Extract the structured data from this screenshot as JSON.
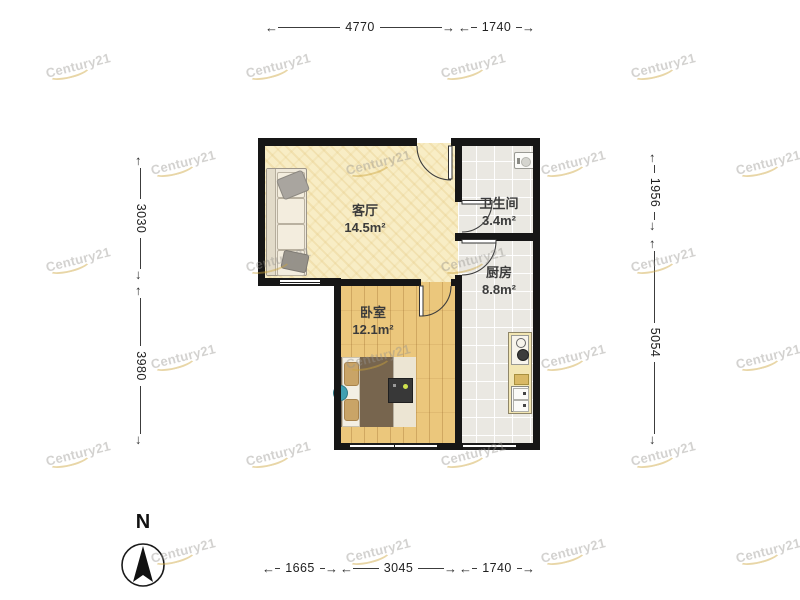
{
  "floorplan": {
    "rooms": [
      {
        "name": "living-room",
        "label": "客厅",
        "area": "14.5m²"
      },
      {
        "name": "bathroom",
        "label": "卫生间",
        "area": "3.4m²"
      },
      {
        "name": "kitchen",
        "label": "厨房",
        "area": "8.8m²"
      },
      {
        "name": "bedroom",
        "label": "卧室",
        "area": "12.1m²"
      }
    ],
    "dimensions_mm": {
      "top": [
        "4770",
        "1740"
      ],
      "bottom": [
        "1665",
        "3045",
        "1740"
      ],
      "left": [
        "3030",
        "3980"
      ],
      "right": [
        "1956",
        "5054"
      ]
    },
    "compass_label": "N",
    "watermark_text": "Century21",
    "colors": {
      "wall": "#161616",
      "living_floor": "#f8edc5",
      "bedroom_floor": "#ebc77c",
      "tile_floor": "#eae8e2",
      "watermark_gold": "#cda53c"
    }
  },
  "icons": {
    "arrow_left": "←",
    "arrow_right": "→"
  }
}
